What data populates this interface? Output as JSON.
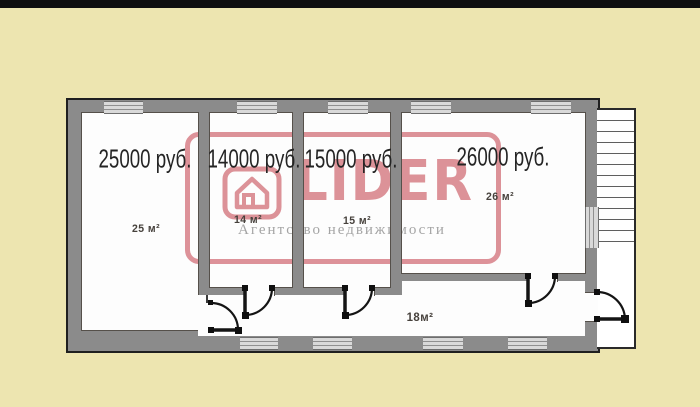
{
  "colors": {
    "background": "#ede5b0",
    "top_bar": "#0f0f0f",
    "wall_fill": "#8b8b8b",
    "wall_edge": "#1f1f1f",
    "room_fill": "#fdfdfd",
    "window_fill": "#d9d9d9",
    "window_line": "#8f8f8f",
    "stair_line": "#5f5f5f",
    "watermark_red": "#c23b47",
    "price_text": "#242424",
    "area_text": "#46413c"
  },
  "watermark": {
    "brand": "LIDER",
    "tagline": "Агентство недвижимости"
  },
  "rooms": [
    {
      "id": "room-25",
      "price": "25000 руб.",
      "area": "25 м²"
    },
    {
      "id": "room-14",
      "price": "14000 руб.",
      "area": "14 м²"
    },
    {
      "id": "room-15",
      "price": "15000 руб.",
      "area": "15 м²"
    },
    {
      "id": "room-26",
      "price": "26000 руб.",
      "area": "26 м²"
    }
  ],
  "corridor": {
    "area": "18м²"
  }
}
